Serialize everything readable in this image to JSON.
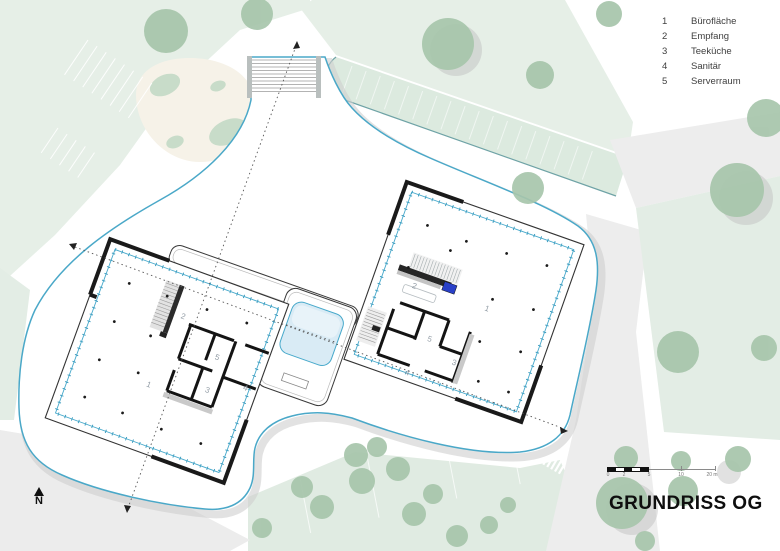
{
  "legend": {
    "items": [
      {
        "num": "1",
        "label": "Bürofläche"
      },
      {
        "num": "2",
        "label": "Empfang"
      },
      {
        "num": "3",
        "label": "Teeküche"
      },
      {
        "num": "4",
        "label": "Sanitär"
      },
      {
        "num": "5",
        "label": "Serverraum"
      }
    ]
  },
  "title": "GRUNDRISS OG",
  "north_label": "N",
  "scalebar": {
    "labels": [
      "0",
      "2",
      "5",
      "10",
      "20 m"
    ]
  },
  "rooms": {
    "left": {
      "r1": "1",
      "r2": "2",
      "r3": "3",
      "r4": "4",
      "r5": "5"
    },
    "right": {
      "r1": "1",
      "r2": "2",
      "r3": "3",
      "r4": "4",
      "r5": "5"
    }
  },
  "colors": {
    "plate_outline": "#4AA8C8",
    "glazing_line": "#47A9CB",
    "atrium_fill": "#D9EBF5",
    "reception_accent": "#2940C8",
    "tree_green": "#A7C5AB",
    "ground_green": "#E4EEE6",
    "road_gray": "#EDEDED",
    "wall_black": "#1A1A1A"
  }
}
